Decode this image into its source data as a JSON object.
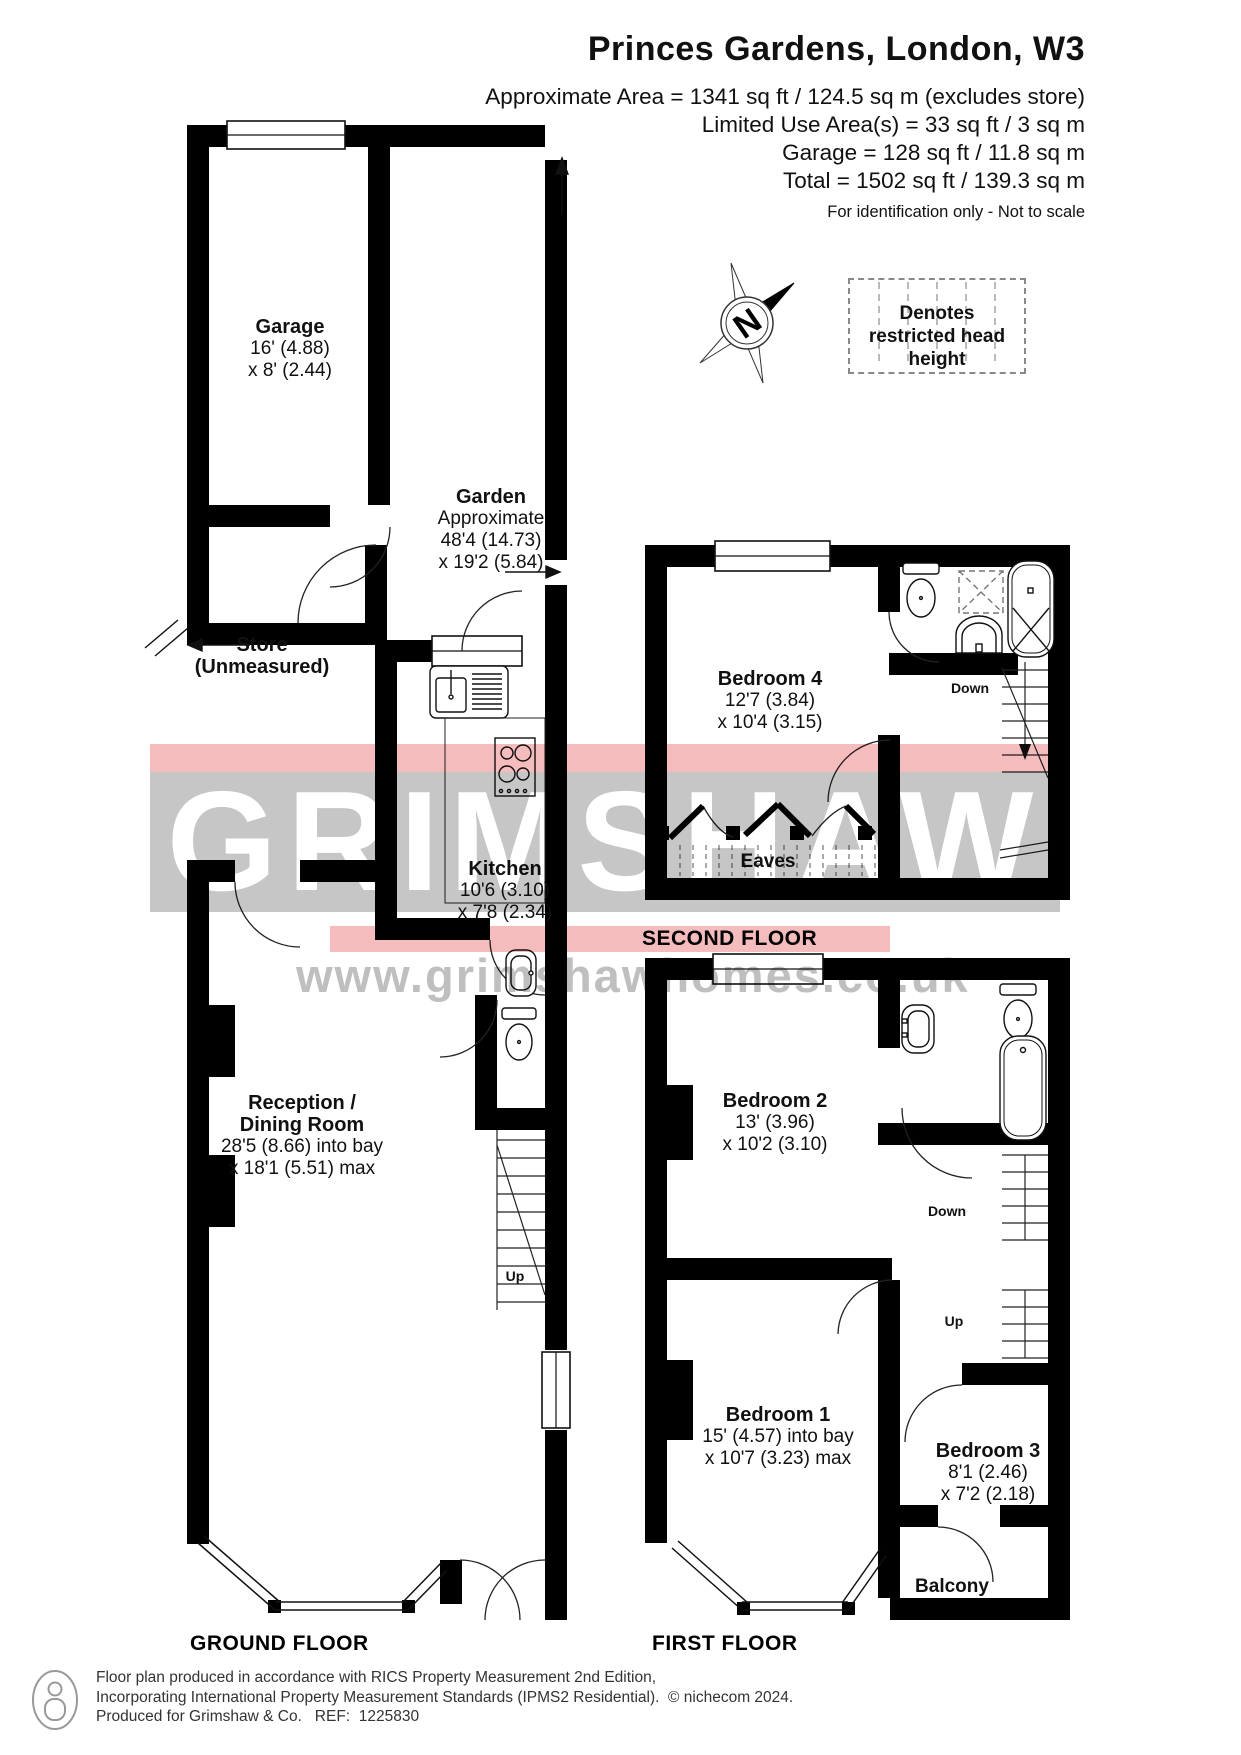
{
  "header": {
    "title": "Princes Gardens, London, W3",
    "area_lines": [
      "Approximate Area = 1341 sq ft / 124.5 sq m (excludes store)",
      "Limited Use Area(s) = 33 sq ft / 3 sq m",
      "Garage = 128 sq ft / 11.8 sq m",
      "Total = 1502 sq ft / 139.3 sq m"
    ],
    "note": "For identification only - Not to scale"
  },
  "legend": {
    "restricted": "Denotes restricted head height"
  },
  "compass": {
    "north": "N"
  },
  "watermark": {
    "brand": "GRIMSHAW",
    "url": "www.grimshawhomes.co.uk",
    "pink": "#f5bcbe",
    "gray": "#c6c6c6"
  },
  "rooms": {
    "garage": {
      "name": "Garage",
      "line1": "16' (4.88)",
      "line2": "x 8' (2.44)"
    },
    "garden": {
      "name": "Garden",
      "line1": "Approximate",
      "line2": "48'4 (14.73)",
      "line3": "x 19'2 (5.84)"
    },
    "store": {
      "name": "Store",
      "line1": "(Unmeasured)"
    },
    "kitchen": {
      "name": "Kitchen",
      "line1": "10'6 (3.10)",
      "line2": "x 7'8 (2.34)"
    },
    "reception": {
      "name1": "Reception /",
      "name2": "Dining Room",
      "line1": "28'5 (8.66) into bay",
      "line2": "x 18'1 (5.51) max"
    },
    "bedroom4": {
      "name": "Bedroom 4",
      "line1": "12'7 (3.84)",
      "line2": "x 10'4 (3.15)"
    },
    "bedroom2": {
      "name": "Bedroom 2",
      "line1": "13' (3.96)",
      "line2": "x 10'2 (3.10)"
    },
    "bedroom1": {
      "name": "Bedroom 1",
      "line1": "15' (4.57) into bay",
      "line2": "x 10'7 (3.23) max"
    },
    "bedroom3": {
      "name": "Bedroom 3",
      "line1": "8'1 (2.46)",
      "line2": "x 7'2 (2.18)"
    },
    "eaves": "Eaves",
    "balcony": "Balcony"
  },
  "nav": {
    "up": "Up",
    "down": "Down"
  },
  "floors": {
    "ground": "GROUND FLOOR",
    "first": "FIRST FLOOR",
    "second": "SECOND FLOOR"
  },
  "footer": {
    "line1": "Floor plan produced in accordance with RICS Property Measurement 2nd Edition,",
    "line2": "Incorporating International Property Measurement Standards (IPMS2 Residential).  © nichecom 2024.",
    "line3": "Produced for Grimshaw & Co.   REF:  1225830"
  }
}
